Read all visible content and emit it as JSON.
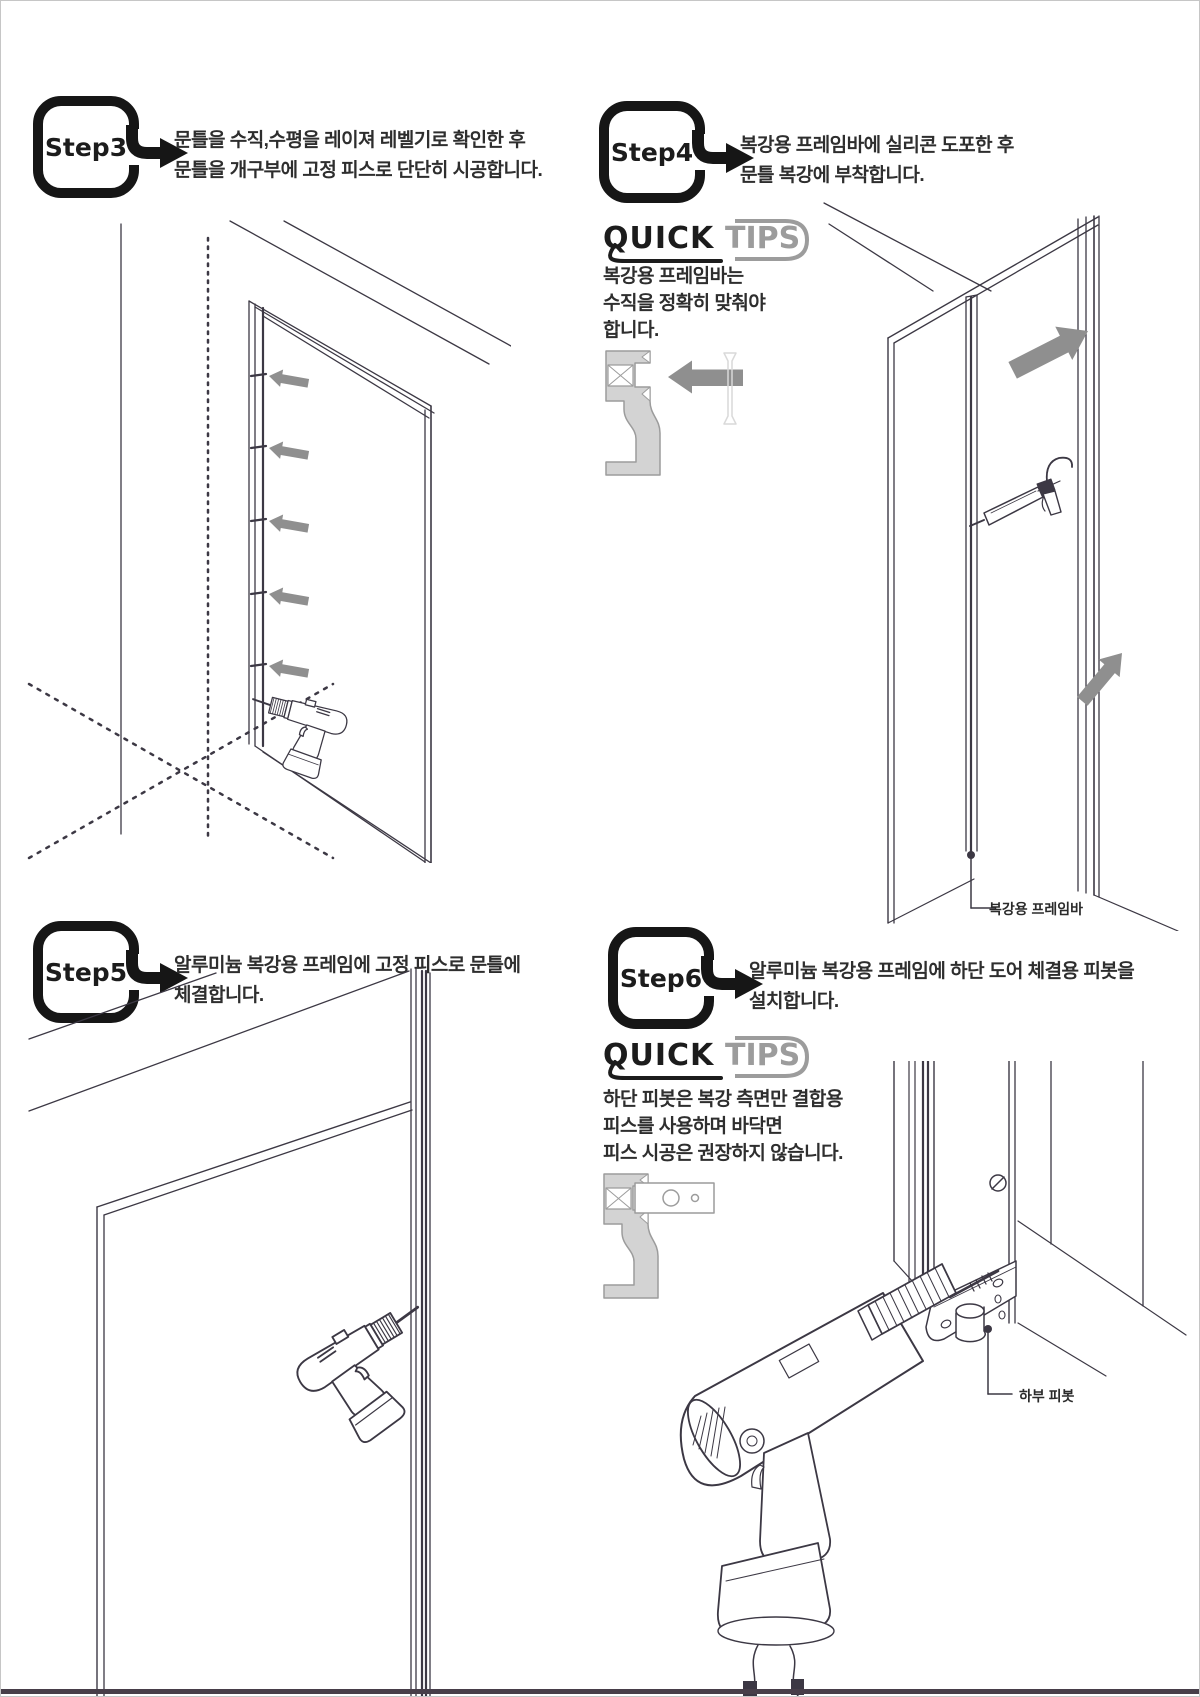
{
  "page": {
    "background": "#ffffff",
    "border_color": "#c6c6c6",
    "footer_bar_color": "#473e49"
  },
  "colors": {
    "ink": "#3c3844",
    "badge_black": "#161616",
    "gray_arrow": "#8f8f8f",
    "tips_gray": "#9c9c9c",
    "profile_fill": "#d3d3d3",
    "faint_outline": "#d9d9d9"
  },
  "steps": [
    {
      "label": "Step3",
      "desc_line1": "문틀을 수직,수평을 레이져 레벨기로 확인한 후",
      "desc_line2": "문틀을 개구부에 고정 피스로 단단히 시공합니다."
    },
    {
      "label": "Step4",
      "desc_line1": "복강용 프레임바에 실리콘 도포한 후",
      "desc_line2": "문틀 복강에 부착합니다."
    },
    {
      "label": "Step5",
      "desc_line1": "알루미늄 복강용 프레임에 고정 피스로 문틀에",
      "desc_line2": "체결합니다."
    },
    {
      "label": "Step6",
      "desc_line1": "알루미늄 복강용 프레임에 하단 도어 체결용 피봇을",
      "desc_line2": "설치합니다."
    }
  ],
  "quick_tips": {
    "quick": "QUICK",
    "tips": "TIPS",
    "step4": {
      "line1": "복강용 프레임바는",
      "line2": "수직을 정확히 맞춰야",
      "line3": "합니다."
    },
    "step6": {
      "line1": "하단 피봇은 복강 측면만 결합용",
      "line2": "피스를 사용하며 바닥면",
      "line3": "피스 시공은 권장하지 않습니다."
    }
  },
  "callouts": {
    "frame_bar": "복강용 프레임바",
    "lower_pivot": "하부 피봇"
  }
}
